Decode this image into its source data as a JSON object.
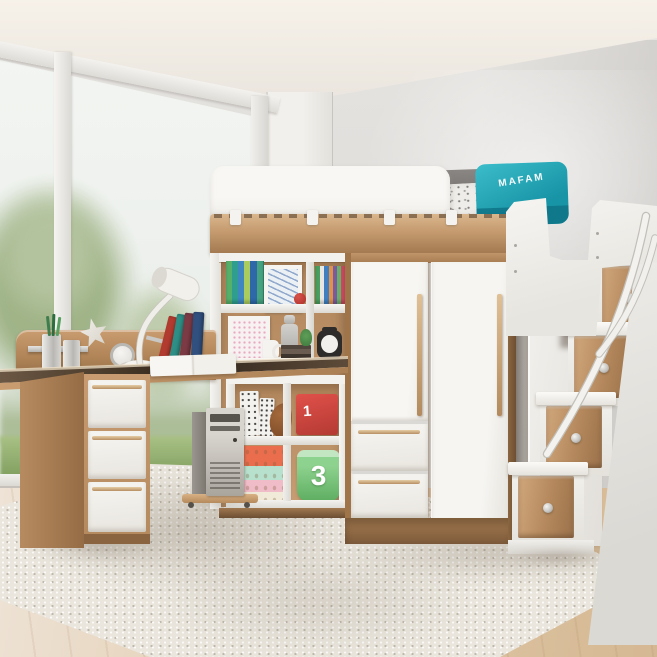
{
  "colors": {
    "ceiling-1": "#f6f1e9",
    "ceiling-2": "#e8e3dc",
    "wall-1": "#e7e5e2",
    "wall-2": "#d7d5d2",
    "pillar-1": "#f2f0ec",
    "pillar-2": "#e3e1dc",
    "frame-1": "#f3f2ef",
    "frame-2": "#dedcd7",
    "sky-1": "#f3f5f2",
    "sky-2": "#eaeeea",
    "tree-1": "#9cb183",
    "tree-2": "#b8c7a3",
    "grass-1": "#a9c185",
    "grass-2": "#7e9d5d",
    "wood-light": "#dab68d",
    "wood": "#c49a6e",
    "wood-dark": "#a27950",
    "panel-1": "#f8f7f4",
    "panel-2": "#e8e6e1",
    "teal-1": "#3cbdca",
    "teal-2": "#1794a6",
    "teal-dark": "#0e7386",
    "pillow-1": "#8a8683",
    "pillow-2": "#635f5c",
    "duvet": "#efede9",
    "red-1": "#e0514a",
    "red-2": "#b43a33",
    "bucket-1": "#8ed28f",
    "bucket-2": "#5dad60",
    "coral": "#ea6e4e",
    "mint": "#b7e0cd",
    "pink-band": "#f0bcc8",
    "cream": "#f2ead9",
    "glove-1": "#a4693c",
    "glove-2": "#7c4a26",
    "rug-1": "#eae6dd",
    "floor-1": "#eee3d6",
    "floor-2": "#e0c8a8",
    "floor-3": "#d5b893",
    "dark": "#2e2c2a",
    "book-1": "#57b06a",
    "book-2": "#2f9e8f",
    "book-3": "#3f87c0",
    "book-4": "#aacb5e",
    "book-5": "#2e68a8",
    "book-6": "#45a381",
    "lean-1": "#b23b30",
    "lean-2": "#2e8f86",
    "lean-3": "#7c3a45",
    "lean-4": "#31507f"
  },
  "bed": {
    "cushion_text": "MAFAM"
  },
  "storage": {
    "red_box_label": "1",
    "green_bucket_label": "3"
  }
}
